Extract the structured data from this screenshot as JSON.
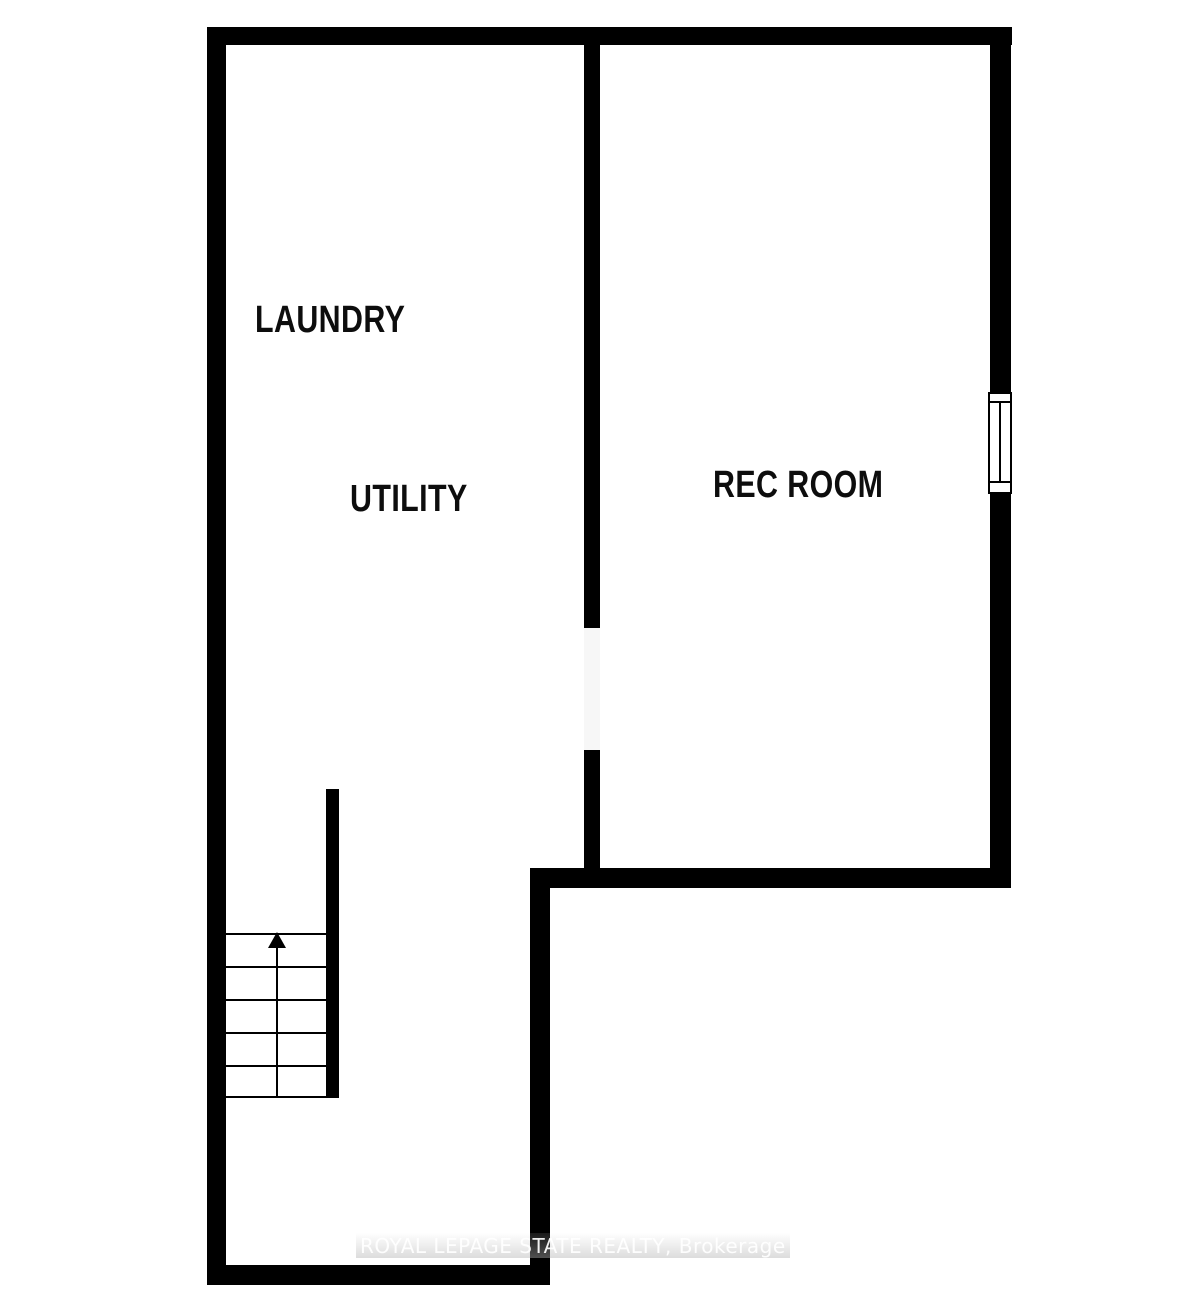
{
  "plan": {
    "rooms": [
      {
        "id": "laundry",
        "label": "LAUNDRY"
      },
      {
        "id": "utility",
        "label": "UTILITY"
      },
      {
        "id": "rec_room",
        "label": "REC ROOM"
      }
    ],
    "features": {
      "window_icon": "window-icon",
      "stair_arrow_icon": "up-arrow-icon",
      "stairs_step_count": 5,
      "door_opening": "cased-opening"
    },
    "colors": {
      "wall": "#000000",
      "background": "#ffffff",
      "watermark_text": "#ffffff",
      "watermark_band": "#d9d9d9"
    },
    "watermark": {
      "text": "ROYAL LEPAGE STATE REALTY, Brokerage"
    }
  }
}
